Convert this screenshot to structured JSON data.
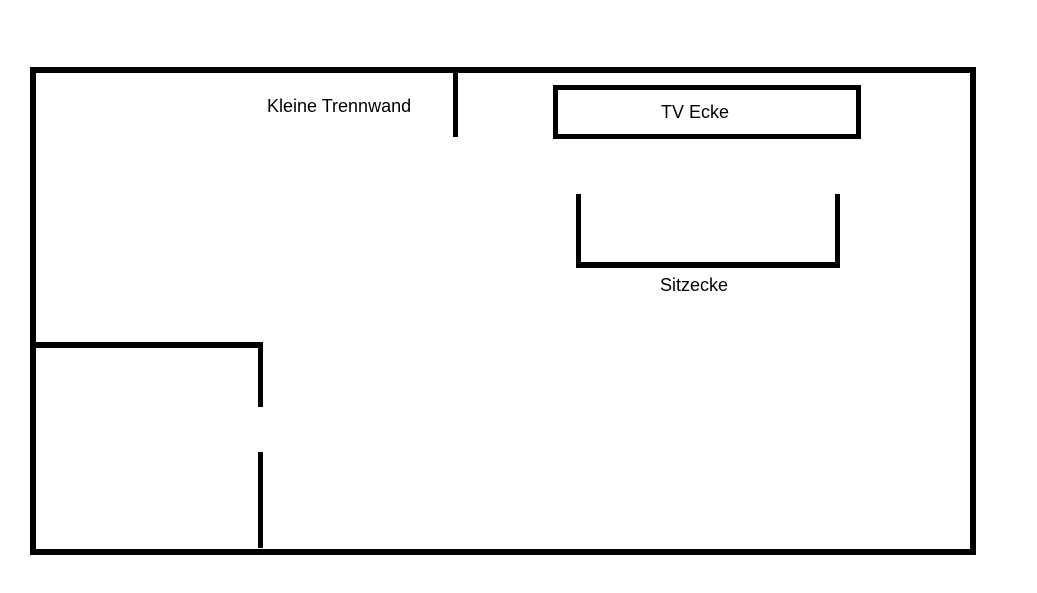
{
  "page": {
    "background_color": "#ffffff",
    "line_color": "#000000"
  },
  "plan": {
    "partition_label": "Kleine Trennwand",
    "tv_label": "TV Ecke",
    "seating_label": "Sitzecke"
  }
}
